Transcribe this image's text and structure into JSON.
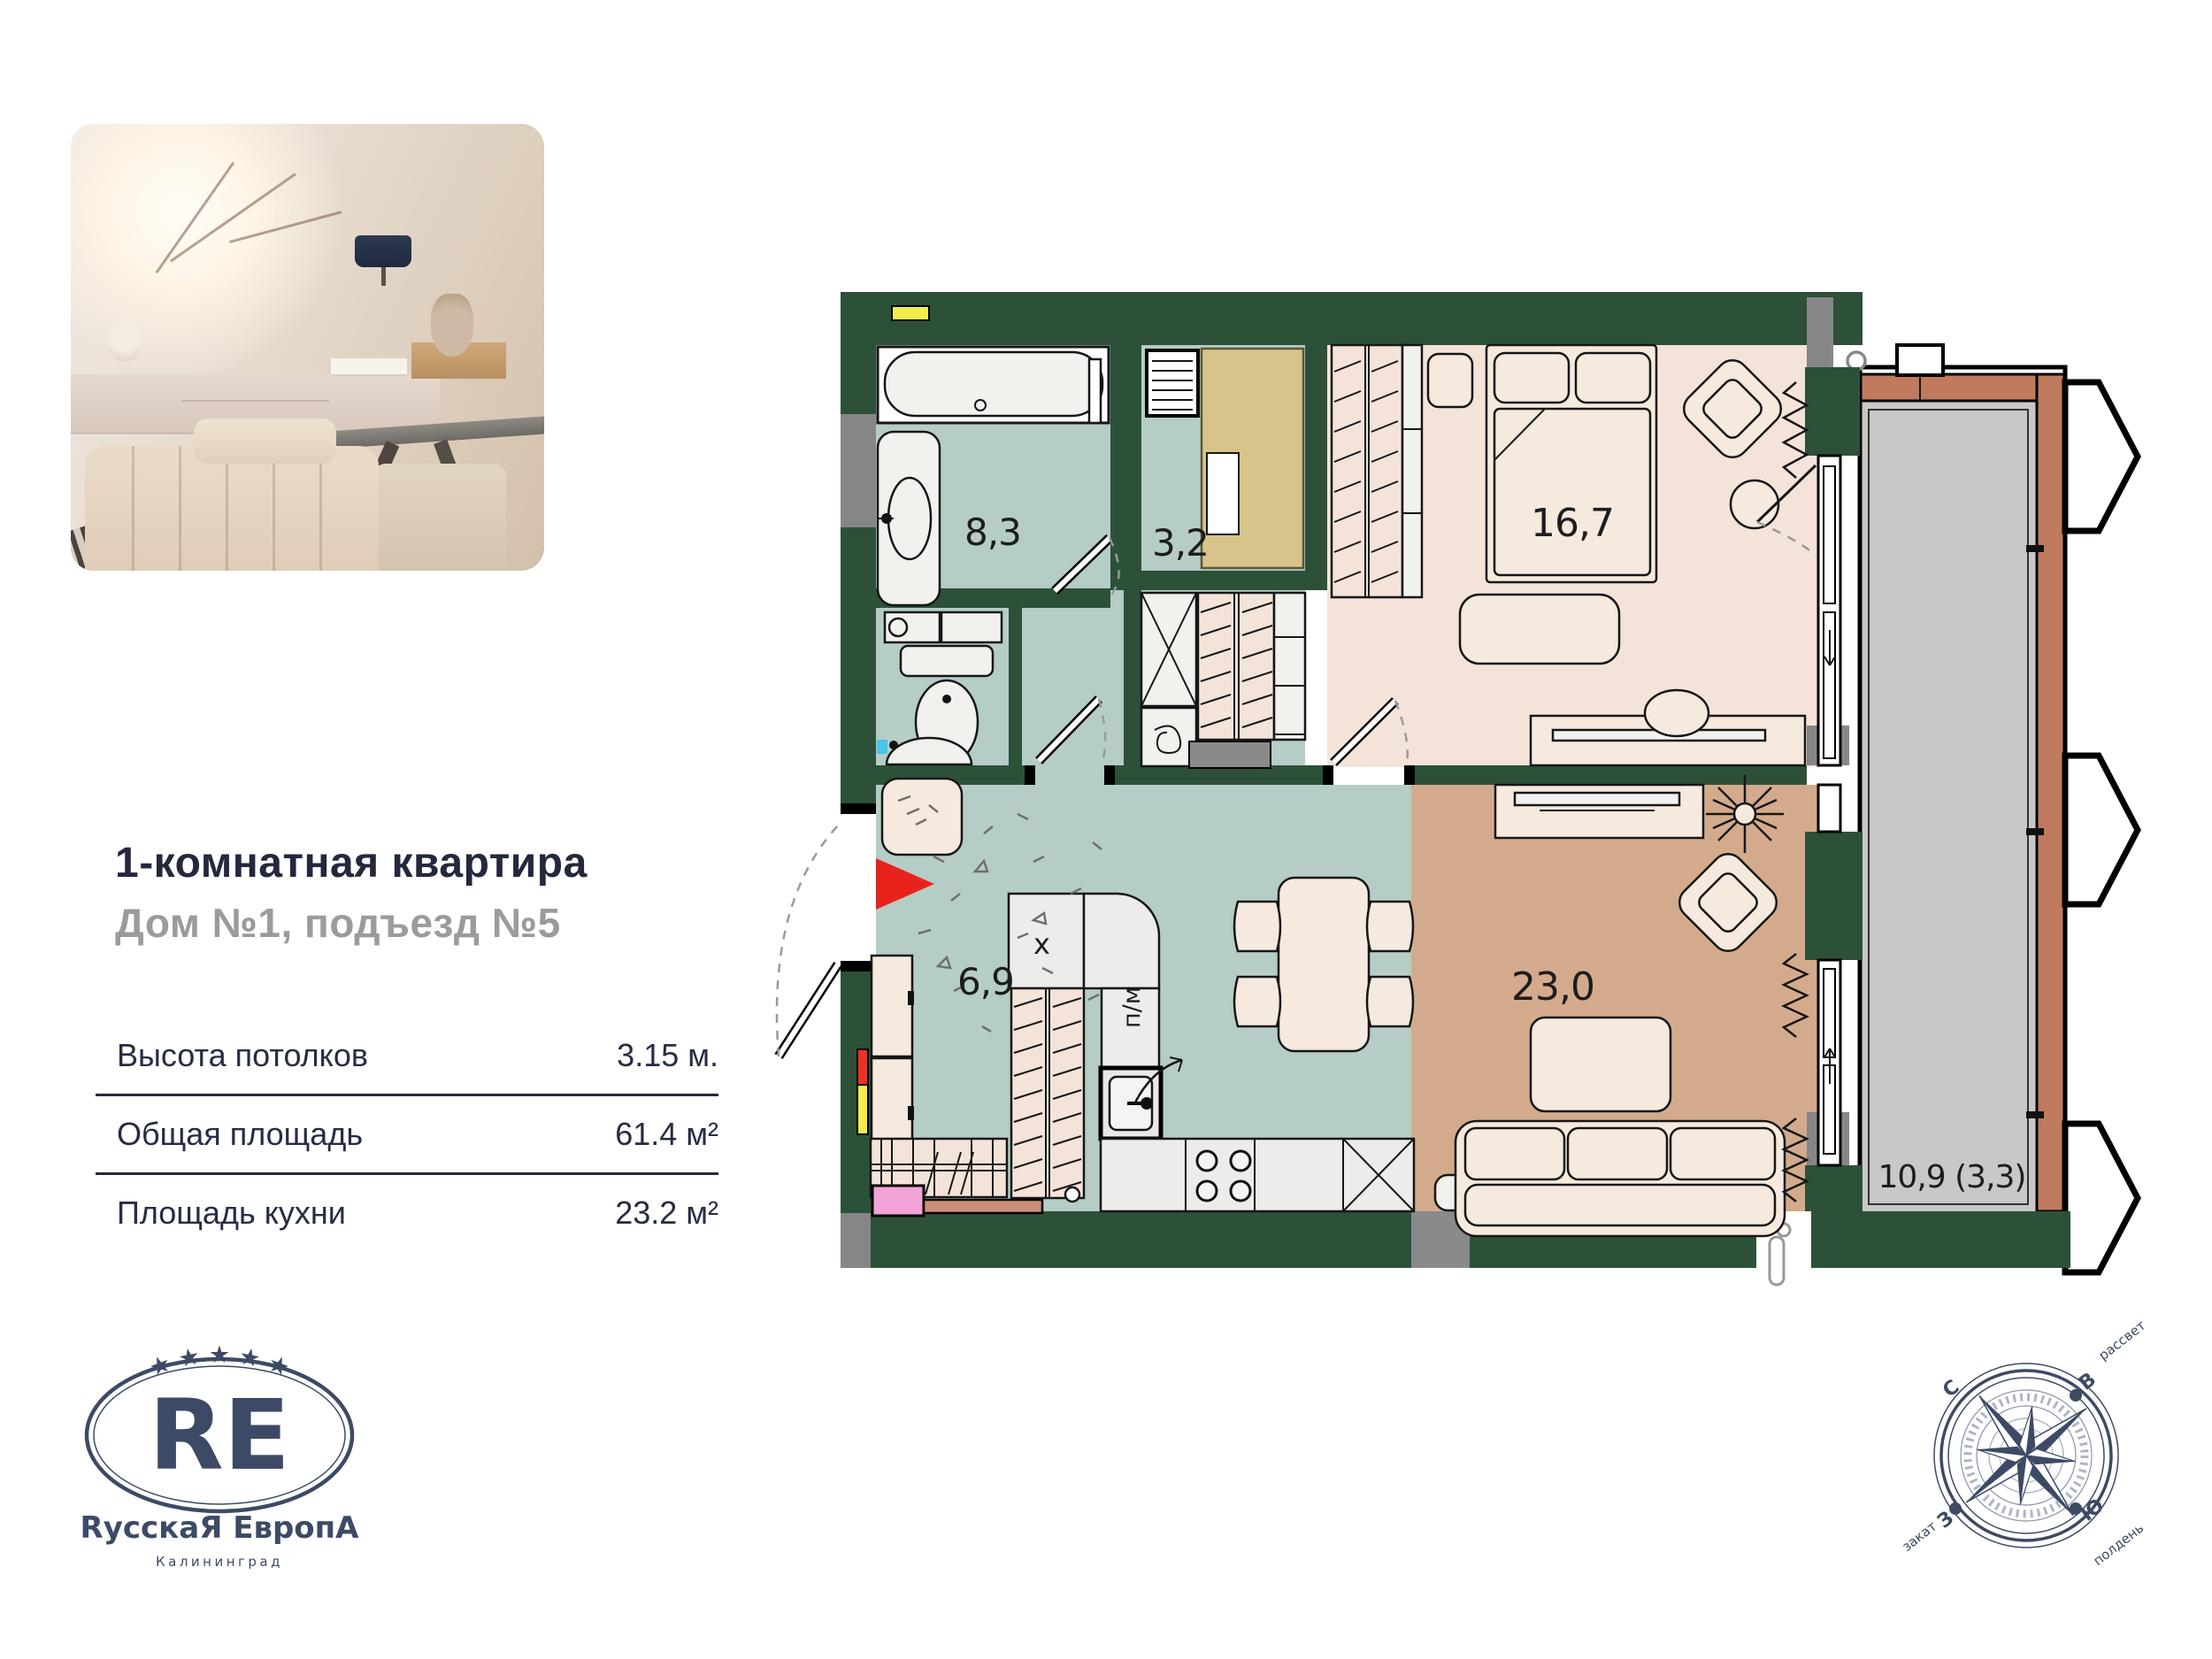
{
  "listing": {
    "title": "1-комнатная квартира",
    "subtitle": "Дом №1, подъезд №5"
  },
  "specs": {
    "rows": [
      {
        "label": "Высота потолков",
        "value": "3.15 м."
      },
      {
        "label": "Общая площадь",
        "value": "61.4 м²"
      },
      {
        "label": "Площадь кухни",
        "value": "23.2 м²"
      }
    ]
  },
  "logo": {
    "stars": "★ ★ ★ ★ ★",
    "monogram": "RE",
    "name": "RусскаЯ ЕвропА",
    "city": "Калининград"
  },
  "plan": {
    "rooms": {
      "bathroom": "8,3",
      "closet": "3,2",
      "bedroom": "16,7",
      "hall": "6,9",
      "kitchen_living": "23,0",
      "loggia": "10,9 (3,3)"
    },
    "appliances": {
      "fridge": "х",
      "dishwasher": "п/м"
    },
    "colors": {
      "wall_green": "#2d5038",
      "wet_floor_teal": "#b5cdc6",
      "room_floor_pink": "#f4e3d8",
      "living_floor_tan": "#d3ab8c",
      "loggia_floor_gray": "#cac8c6",
      "facade_terracotta": "#c07a5e",
      "closet_khaki": "#d8c48a",
      "entry_arrow_red": "#e8231c",
      "marker_yellow": "#f3ec4f",
      "marker_pink": "#f2a3d8",
      "marker_cyan": "#45c6ea"
    }
  },
  "compass": {
    "north": "С",
    "east": "В",
    "west": "З",
    "south": "Ю",
    "dawn": "рассвет",
    "sunset": "закат",
    "noon": "полдень"
  }
}
